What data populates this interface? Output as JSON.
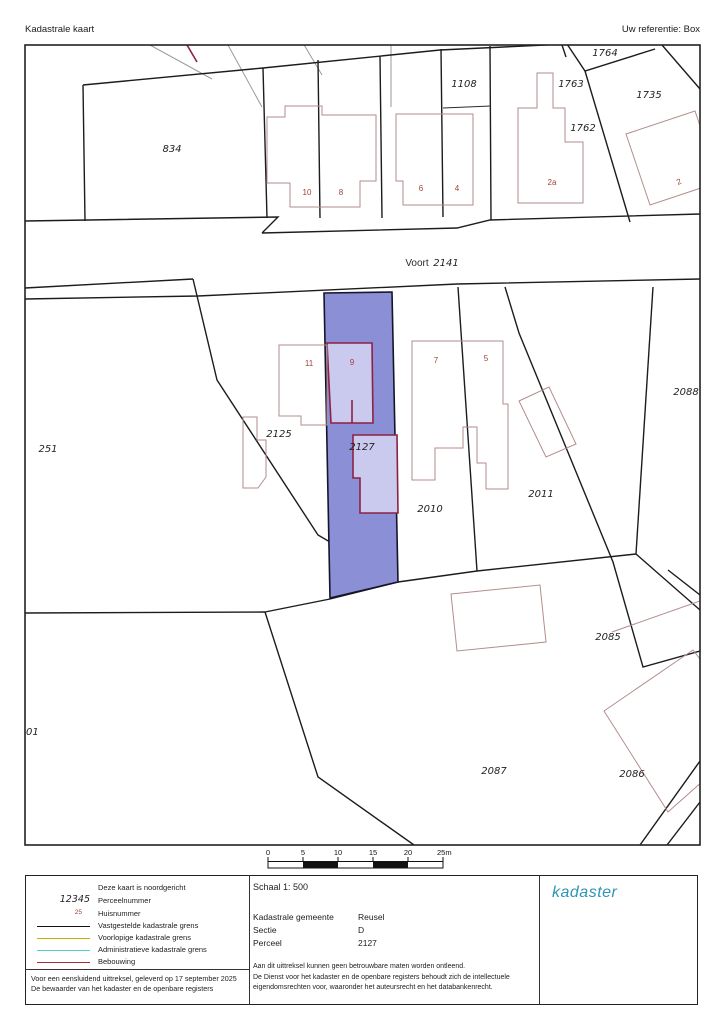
{
  "header": {
    "title": "Kadastrale kaart",
    "reference": "Uw referentie: Box"
  },
  "map": {
    "labels": [
      {
        "t": "834",
        "x": 172,
        "y": 152,
        "k": "parcel"
      },
      {
        "t": "1108",
        "x": 464,
        "y": 87,
        "k": "parcel"
      },
      {
        "t": "1764",
        "x": 605,
        "y": 56,
        "k": "parcel"
      },
      {
        "t": "1763",
        "x": 571,
        "y": 87,
        "k": "parcel"
      },
      {
        "t": "1735",
        "x": 649,
        "y": 98,
        "k": "parcel"
      },
      {
        "t": "1762",
        "x": 583,
        "y": 131,
        "k": "parcel"
      },
      {
        "t": "10",
        "x": 307,
        "y": 195,
        "k": "house"
      },
      {
        "t": "8",
        "x": 341,
        "y": 195,
        "k": "house"
      },
      {
        "t": "6",
        "x": 421,
        "y": 191,
        "k": "house"
      },
      {
        "t": "4",
        "x": 457,
        "y": 191,
        "k": "house"
      },
      {
        "t": "2a",
        "x": 552,
        "y": 185,
        "k": "house"
      },
      {
        "t": "2",
        "x": 680,
        "y": 184,
        "k": "house",
        "rot": -25
      },
      {
        "t": "Voort",
        "x": 417,
        "y": 266,
        "k": "street"
      },
      {
        "t": "2141",
        "x": 446,
        "y": 266,
        "k": "parcel"
      },
      {
        "t": "11",
        "x": 309,
        "y": 366,
        "k": "house"
      },
      {
        "t": "9",
        "x": 352,
        "y": 365,
        "k": "house"
      },
      {
        "t": "7",
        "x": 436,
        "y": 363,
        "k": "house"
      },
      {
        "t": "5",
        "x": 486,
        "y": 361,
        "k": "house"
      },
      {
        "t": "2125",
        "x": 279,
        "y": 437,
        "k": "parcel"
      },
      {
        "t": "2127",
        "x": 362,
        "y": 450,
        "k": "parcel"
      },
      {
        "t": "2010",
        "x": 430,
        "y": 512,
        "k": "parcel"
      },
      {
        "t": "2011",
        "x": 541,
        "y": 497,
        "k": "parcel"
      },
      {
        "t": "2088",
        "x": 686,
        "y": 395,
        "k": "parcel"
      },
      {
        "t": "251",
        "x": 48,
        "y": 452,
        "k": "parcel"
      },
      {
        "t": "01",
        "x": 26,
        "y": 735,
        "k": "parcel",
        "anchor": "start"
      },
      {
        "t": "2085",
        "x": 608,
        "y": 640,
        "k": "parcel"
      },
      {
        "t": "2087",
        "x": 494,
        "y": 774,
        "k": "parcel"
      },
      {
        "t": "2086",
        "x": 632,
        "y": 777,
        "k": "parcel"
      }
    ],
    "colors": {
      "highlight_parcel": "#8a8fd6",
      "highlight_building": "#c9caee",
      "building_outline": "#8e2143",
      "thin_building": "#b18e8c",
      "parcel_line": "#1c1c1c"
    }
  },
  "scalebar": {
    "ticks": [
      "0",
      "5",
      "10",
      "15",
      "20",
      "25m"
    ]
  },
  "footer": {
    "legend": {
      "north_note": "Deze kaart is noordgericht",
      "parcel_sample": "12345",
      "parcel_label": "Perceelnummer",
      "house_sample": "25",
      "house_label": "Huisnummer",
      "items": [
        {
          "label": "Vastgestelde kadastrale grens",
          "color": "#111111"
        },
        {
          "label": "Voorlopige kadastrale grens",
          "color": "#c3b100"
        },
        {
          "label": "Administratieve kadastrale grens",
          "color": "#52d0c8"
        },
        {
          "label": "Bebouwing",
          "color": "#9c3434"
        }
      ]
    },
    "certificate_line1": "Voor een eensluidend uittreksel, geleverd op 17 september 2025",
    "certificate_line2": "De bewaarder van het kadaster en de openbare registers",
    "scale_label": "Schaal 1: 500",
    "info_rows": [
      {
        "label": "Kadastrale gemeente",
        "value": "Reusel"
      },
      {
        "label": "Sectie",
        "value": "D"
      },
      {
        "label": "Perceel",
        "value": "2127"
      }
    ],
    "disclaimer_line1": "Aan dit uittreksel kunnen geen betrouwbare maten worden ontleend.",
    "disclaimer_line2": "De Dienst voor het kadaster en de openbare registers behoudt zich de intellectuele",
    "disclaimer_line3": "eigendomsrechten voor, waaronder het auteursrecht en het databankenrecht.",
    "logo_text": "kadaster"
  }
}
